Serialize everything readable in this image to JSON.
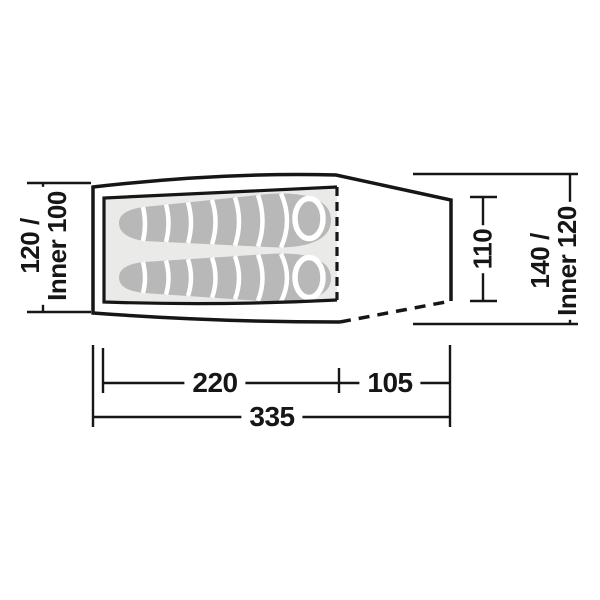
{
  "labels": {
    "front_width": {
      "line1": "120 /",
      "line2": "Inner 100"
    },
    "door_height": "110",
    "rear_width": {
      "line1": "140 /",
      "line2": "Inner 120"
    },
    "inner_length": "220",
    "porch_length": "105",
    "total_length": "335"
  },
  "colors": {
    "line": "#161616",
    "outline_fill": "#ffffff",
    "inner_tent_fill": "#eaeae9",
    "sleeping_bag_fill": "#b7b8b7",
    "baffle_line": "#ffffff",
    "background": "#ffffff"
  }
}
